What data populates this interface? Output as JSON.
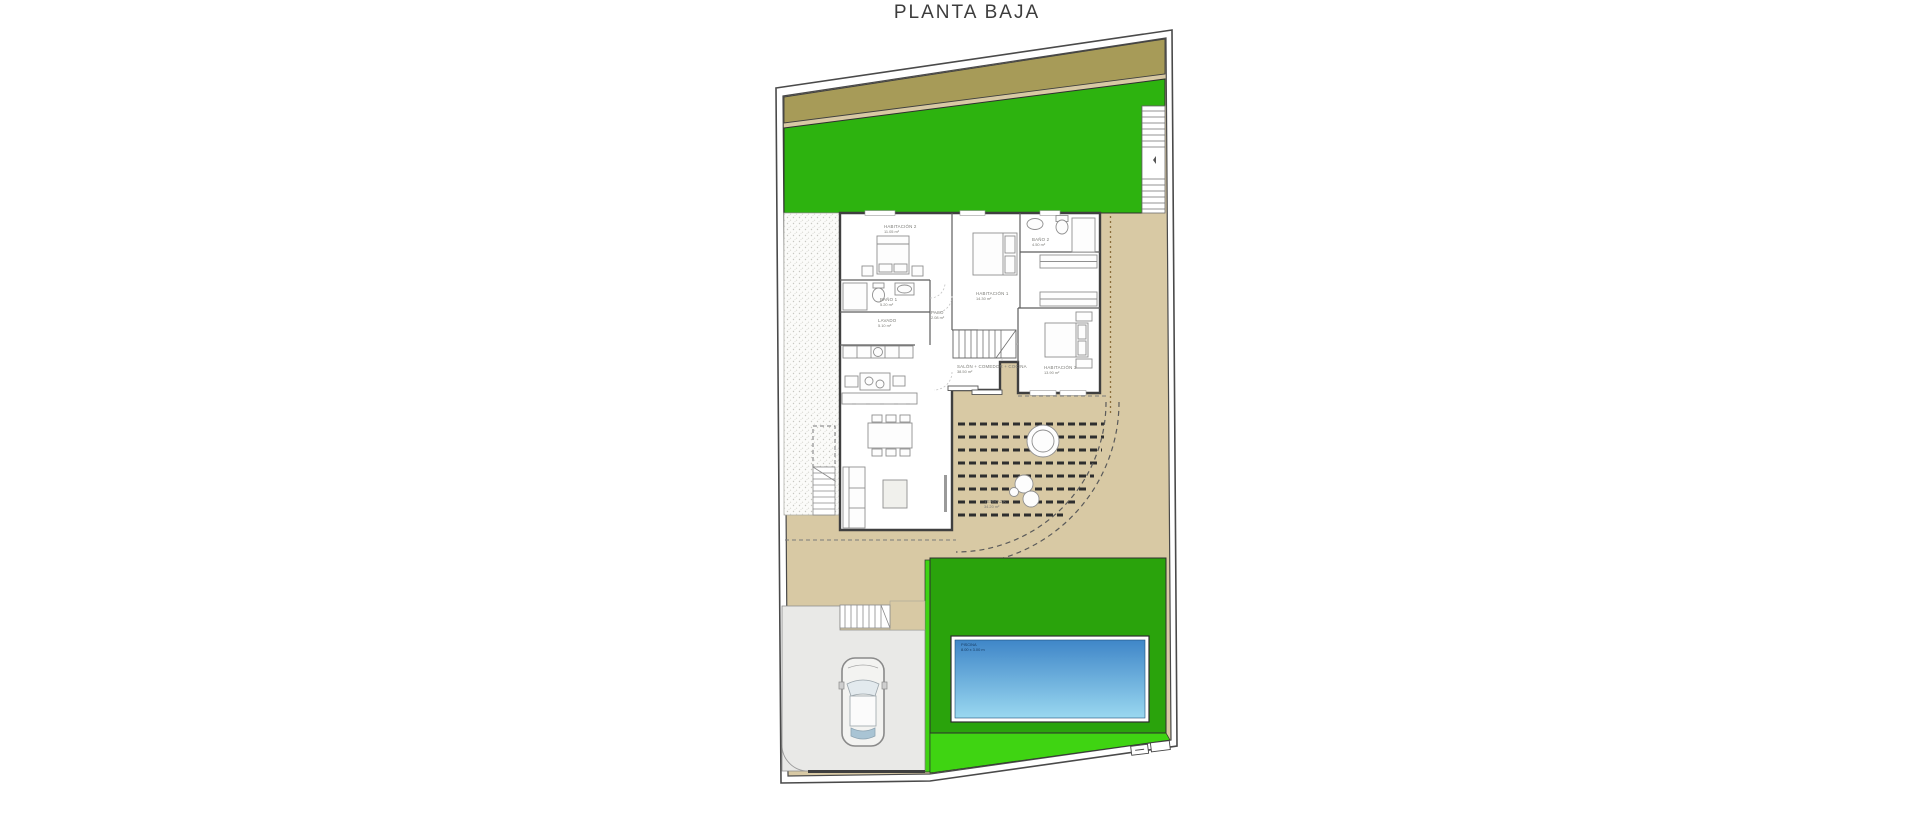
{
  "title": "PLANTA BAJA",
  "colors": {
    "lawn_green": "#2db30f",
    "pool_lawn_green": "#2aa30c",
    "bright_green": "#3fd412",
    "olive_band": "#a79b58",
    "terrace_tan": "#d8c9a4",
    "driveway_gray": "#e9e9e7",
    "pool_blue_deep": "#3f86c8",
    "pool_blue_light": "#9ad8f0",
    "wall_dark": "#3f3f3f"
  },
  "rooms": {
    "hab2": {
      "name": "HABITACIÓN 2",
      "area": "11.05 m²"
    },
    "hab1": {
      "name": "HABITACIÓN 1",
      "area": "14.30 m²"
    },
    "bano2": {
      "name": "BAÑO 2",
      "area": "4.50 m²"
    },
    "bano1": {
      "name": "BAÑO 1",
      "area": "5.20 m²"
    },
    "lavado": {
      "name": "LAVADO",
      "area": "5.10 m²"
    },
    "paso": {
      "name": "PASO",
      "area": "2.08 m²"
    },
    "salon": {
      "name": "SALÓN + COMEDOR + COCINA",
      "area": "38.50 m²"
    },
    "hab3": {
      "name": "HABITACIÓN 3",
      "area": "13.90 m²"
    },
    "terraza": {
      "name": "TERRAZA",
      "area": "34.20 m²"
    },
    "piscina": {
      "name": "PISCINA",
      "dims": "8.00 x 3.00 m"
    }
  }
}
